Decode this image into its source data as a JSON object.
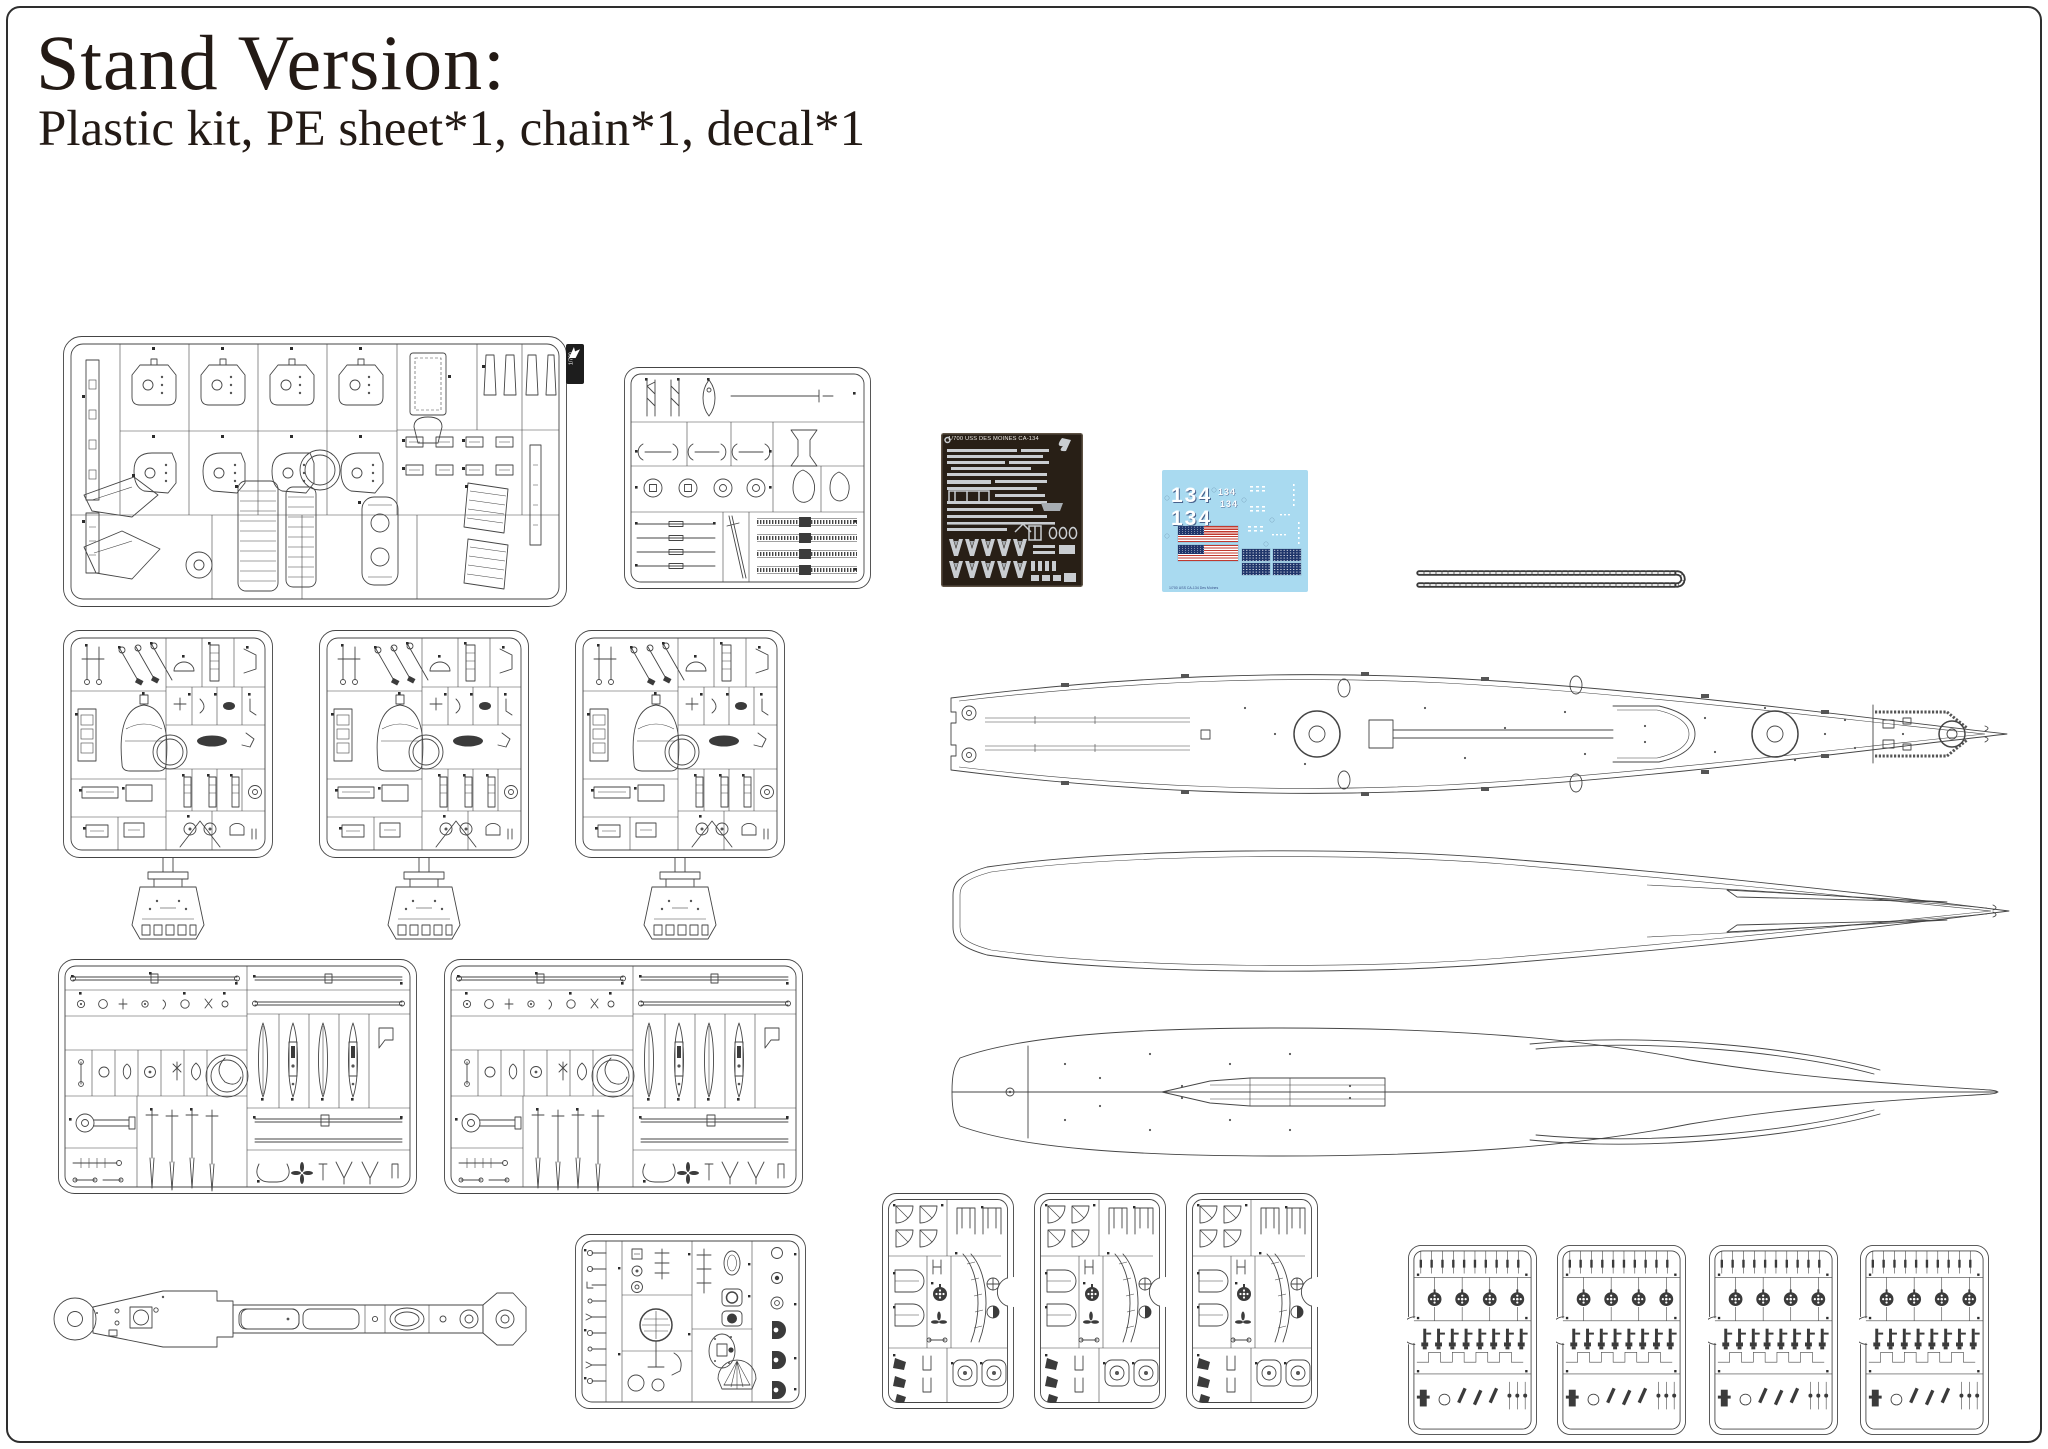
{
  "page": {
    "title": "Stand Version:",
    "subtitle": "Plastic kit, PE sheet*1, chain*1, decal*1"
  },
  "sprue_a": {
    "tag_label": "1/700"
  },
  "pe_sheet": {
    "title": "1/700 USS DES MOINES   CA-134"
  },
  "decal_sheet": {
    "hull_number_big_1": "134",
    "hull_number_big_2": "134",
    "hull_number_small_1": "134",
    "hull_number_small_2": "134",
    "footer": "1/700 USS CA-134 Des Moines"
  },
  "colors": {
    "line": "#454545",
    "pe_background": "#281f16",
    "pe_metal": "#c9cdd1",
    "decal_background": "#a9daf0",
    "flag_red": "#c0392f",
    "flag_navy": "#20366b",
    "chain": "#3a3a3a"
  }
}
